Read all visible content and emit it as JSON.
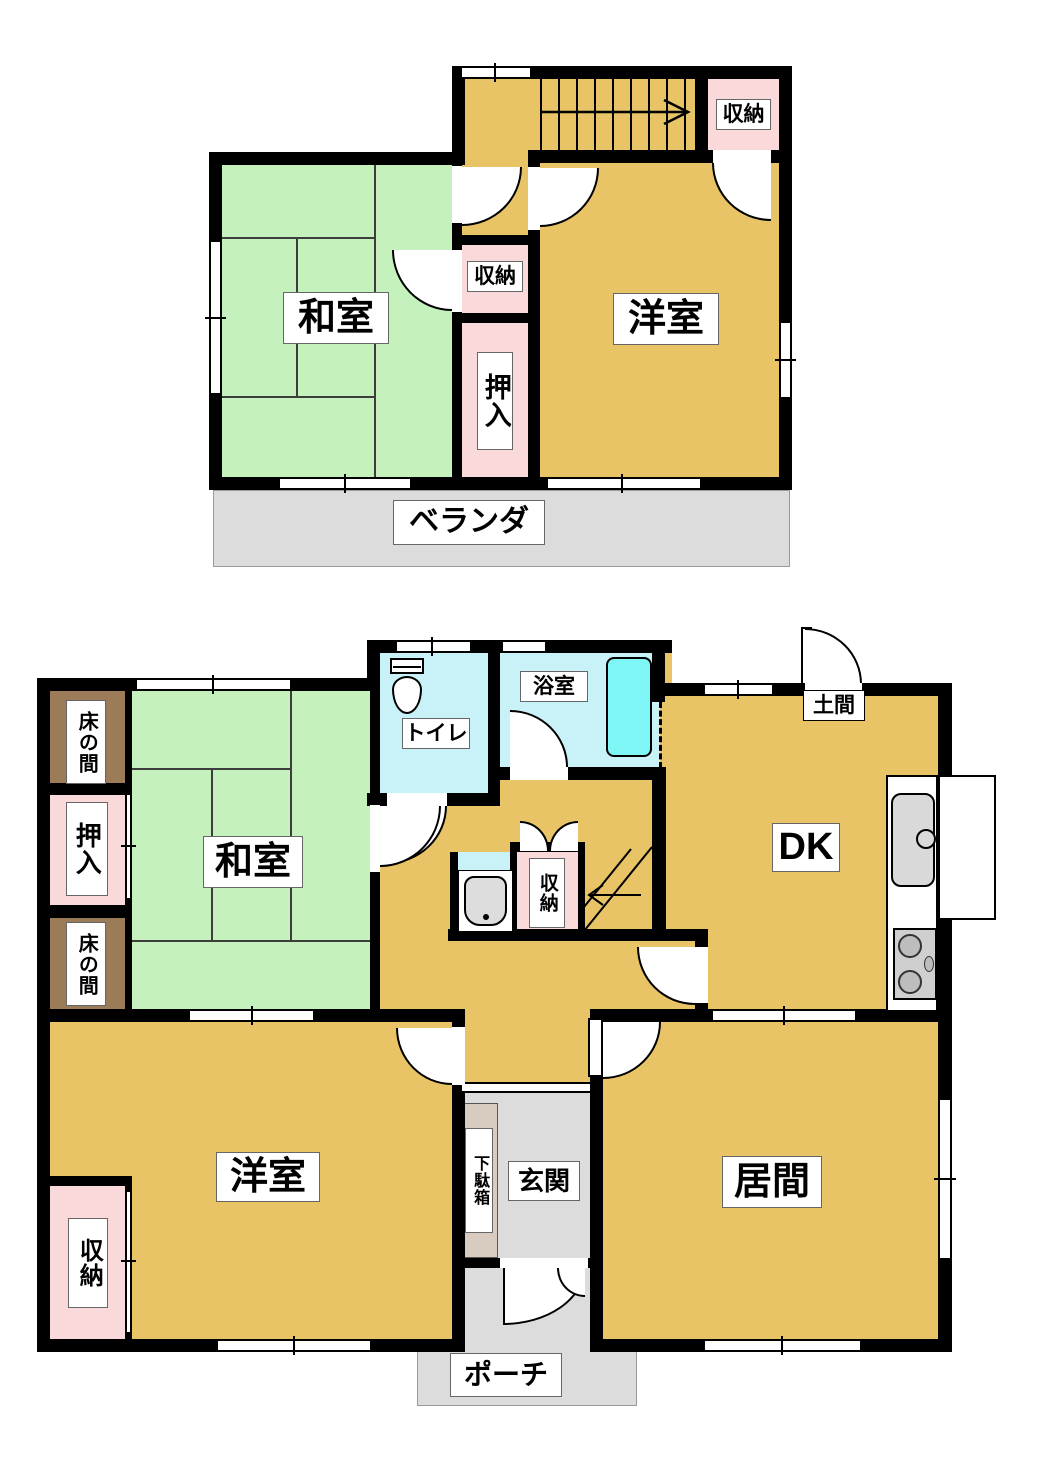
{
  "colors": {
    "room_tan": "#E8C467",
    "tatami_green": "#C4F1BC",
    "closet_pink": "#F9D9DA",
    "tokonoma_brown": "#9B7B58",
    "wet_blue": "#C9F1F8",
    "tub_cyan": "#7EF6F6",
    "outdoor_gray": "#DCDCDC",
    "getabako_beige": "#D8CCC1",
    "wall_black": "#000000"
  },
  "floor2": {
    "rooms": {
      "washitsu": {
        "label": "和室"
      },
      "youshitsu": {
        "label": "洋室"
      },
      "closet_stairs": {
        "label": "収納"
      },
      "closet_hall": {
        "label": "収納"
      },
      "oshiire": {
        "label": "押入"
      },
      "veranda": {
        "label": "ベランダ"
      }
    }
  },
  "floor1": {
    "rooms": {
      "tokonoma_upper": {
        "label": "床の間"
      },
      "oshiire": {
        "label": "押入"
      },
      "tokonoma_lower": {
        "label": "床の間"
      },
      "washitsu": {
        "label": "和室"
      },
      "toilet": {
        "label": "トイレ"
      },
      "bath": {
        "label": "浴室"
      },
      "doma": {
        "label": "土間"
      },
      "dk": {
        "label": "DK"
      },
      "closet_hall": {
        "label": "収納"
      },
      "youshitsu": {
        "label": "洋室"
      },
      "closet_youshitsu": {
        "label": "収納"
      },
      "getabako": {
        "label": "下駄箱"
      },
      "genkan": {
        "label": "玄関"
      },
      "ima": {
        "label": "居間"
      },
      "porch": {
        "label": "ポーチ"
      }
    }
  }
}
